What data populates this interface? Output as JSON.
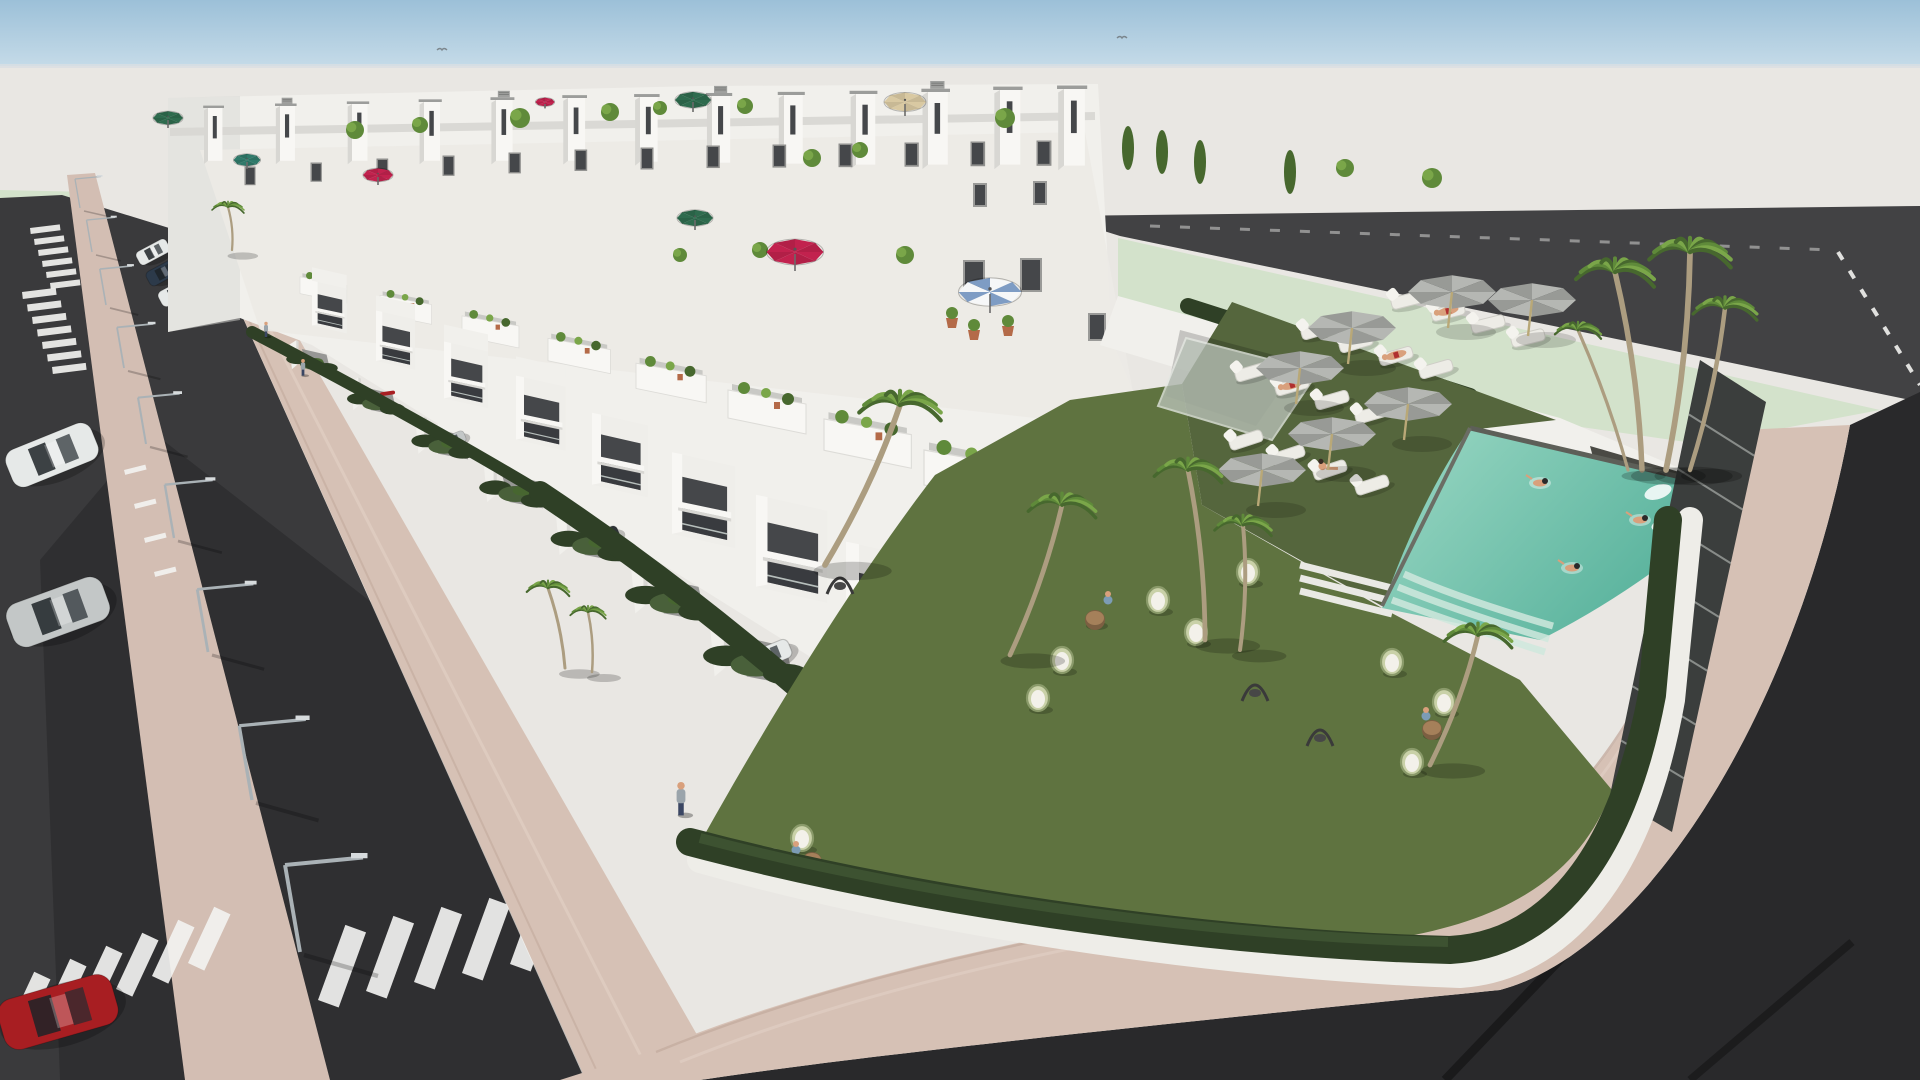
{
  "scene": {
    "description_labels": {
      "subject": "aerial-3d-render-residential-complex-with-pool",
      "sky": "clear-sky-band",
      "foreground": "asphalt-street-with-crosswalks",
      "amenity": "communal-pool-garden"
    },
    "palette": {
      "sky_top": "#9cc0d8",
      "sky_bottom": "#c7dce9",
      "horizon": "#d9dfe2",
      "backdrop": "#e9e7e3",
      "road": "#3a3a3c",
      "road_far": "#424244",
      "road_corner": "#29292b",
      "road_line": "#f2f2f0",
      "pavement": "#d6c1b5",
      "pavement_edge": "#c4aca0",
      "pavement_light": "#e3d2c7",
      "median": "#d3beb3",
      "wall_white": "#f1f0ec",
      "wall_bright": "#f8f7f4",
      "wall_shade": "#d8d7d3",
      "wall_dark": "#bfbeba",
      "glass": "#45474a",
      "glass_dark": "#323438",
      "rail": "#ccd5d1",
      "green_bg": "#d3e2cb",
      "hedge": "#2f4026",
      "hedge_light": "#49603a",
      "lawn": "#5f7340",
      "lawn_dark": "#55663d",
      "pool_light": "#9bd8c4",
      "pool_deep": "#58b29c",
      "pool_step": "#cfe8dd",
      "palm_dark": "#47682e",
      "palm_mid": "#5f8a3a",
      "palm_light": "#7aa649",
      "trunk": "#ac9d80",
      "parasol": "#b5b7b3",
      "parasol_shade": "#989a96",
      "lounger": "#edece6",
      "umbrella_green": "#2e6b4e",
      "umbrella_teal": "#2f7a6a",
      "umbrella_red": "#c2224e",
      "umbrella_tan": "#d9c9a2",
      "umbrella_stripe_a": "#f6f7f8",
      "umbrella_stripe_b": "#7e9cc4",
      "terracotta": "#b46a48",
      "skin": "#d9a07c",
      "metal": "#aab2b6",
      "car_white": "#e6e9e8",
      "car_silver": "#c3c7c7",
      "car_navy": "#2c3a4a",
      "car_red": "#a81e22",
      "car_yellow": "#c8a23c",
      "car_suv": "#2e3336"
    },
    "birds": [
      [
        442,
        50
      ],
      [
        1122,
        38
      ]
    ],
    "umbrellas": [
      [
        168,
        118,
        0.5,
        "green"
      ],
      [
        247,
        160,
        0.45,
        "teal"
      ],
      [
        545,
        102,
        0.32,
        "red"
      ],
      [
        378,
        175,
        0.5,
        "red"
      ],
      [
        693,
        100,
        0.6,
        "green"
      ],
      [
        695,
        218,
        0.6,
        "green"
      ],
      [
        905,
        102,
        0.7,
        "tan"
      ],
      [
        795,
        252,
        0.95,
        "red"
      ],
      [
        990,
        292,
        1.05,
        "stripe"
      ]
    ],
    "parasols": [
      [
        1452,
        292
      ],
      [
        1532,
        300
      ],
      [
        1352,
        328
      ],
      [
        1300,
        368
      ],
      [
        1408,
        404
      ],
      [
        1332,
        434
      ],
      [
        1262,
        470
      ]
    ],
    "loungers": [
      [
        1408,
        300,
        -14,
        0
      ],
      [
        1448,
        312,
        -14,
        1
      ],
      [
        1488,
        324,
        -14,
        0
      ],
      [
        1528,
        338,
        -14,
        0
      ],
      [
        1318,
        330,
        -16,
        0
      ],
      [
        1356,
        343,
        -16,
        0
      ],
      [
        1396,
        356,
        -16,
        1
      ],
      [
        1436,
        369,
        -16,
        0
      ],
      [
        1252,
        372,
        -16,
        0
      ],
      [
        1292,
        386,
        -16,
        1
      ],
      [
        1332,
        400,
        -16,
        0
      ],
      [
        1372,
        414,
        -16,
        0
      ],
      [
        1246,
        440,
        -18,
        0
      ],
      [
        1288,
        455,
        -18,
        0
      ],
      [
        1330,
        470,
        -18,
        2
      ],
      [
        1372,
        485,
        -18,
        0
      ]
    ],
    "palms": [
      [
        825,
        565,
        900,
        405,
        1.15
      ],
      [
        1010,
        655,
        1062,
        505,
        0.95
      ],
      [
        565,
        668,
        548,
        588,
        0.6
      ],
      [
        592,
        672,
        588,
        612,
        0.5
      ],
      [
        1205,
        640,
        1188,
        470,
        0.95
      ],
      [
        1240,
        650,
        1243,
        525,
        0.8
      ],
      [
        1430,
        765,
        1478,
        635,
        0.95
      ],
      [
        1642,
        470,
        1615,
        272,
        1.1
      ],
      [
        1666,
        470,
        1690,
        252,
        1.15
      ],
      [
        1690,
        470,
        1725,
        308,
        0.9
      ],
      [
        1628,
        470,
        1578,
        330,
        0.65
      ],
      [
        232,
        250,
        228,
        207,
        0.45
      ]
    ],
    "lamps": [
      [
        80,
        208,
        0.5
      ],
      [
        92,
        252,
        0.55
      ],
      [
        106,
        305,
        0.62
      ],
      [
        124,
        368,
        0.7
      ],
      [
        146,
        444,
        0.8
      ],
      [
        174,
        538,
        0.92
      ],
      [
        208,
        652,
        1.08
      ],
      [
        252,
        800,
        1.28
      ],
      [
        300,
        952,
        1.5
      ]
    ],
    "street_cars": [
      [
        153,
        252,
        -28,
        34,
        15,
        "car_white"
      ],
      [
        164,
        272,
        -28,
        36,
        16,
        "car_navy"
      ],
      [
        177,
        292,
        -28,
        38,
        17,
        "car_white"
      ]
    ],
    "parked_cars": [
      [
        52,
        455,
        -22,
        92,
        40,
        "car_white"
      ],
      [
        58,
        612,
        -20,
        102,
        46,
        "car_silver"
      ],
      [
        58,
        1012,
        -16,
        118,
        52,
        "car_red"
      ]
    ],
    "pedestrians": [
      [
        266,
        330,
        0.5
      ],
      [
        303,
        368,
        0.55
      ],
      [
        681,
        800,
        1.1
      ]
    ],
    "swimmers": [
      [
        1540,
        483
      ],
      [
        1572,
        568
      ],
      [
        1640,
        520
      ]
    ],
    "egg_chairs": [
      [
        1158,
        600
      ],
      [
        1248,
        572
      ],
      [
        1196,
        632
      ],
      [
        1062,
        660
      ],
      [
        1038,
        698
      ],
      [
        1392,
        662
      ],
      [
        1444,
        702
      ],
      [
        1412,
        762
      ],
      [
        802,
        838
      ],
      [
        772,
        862
      ]
    ],
    "tables": [
      [
        1095,
        620
      ],
      [
        812,
        862
      ],
      [
        1432,
        730
      ]
    ],
    "sitters": [
      [
        1108,
        600
      ],
      [
        796,
        850
      ],
      [
        1426,
        716
      ]
    ],
    "swings": [
      [
        840,
        578
      ],
      [
        1255,
        685
      ],
      [
        1320,
        730
      ]
    ],
    "crosswalks": [
      {
        "x": 30,
        "y": 228,
        "count": 6,
        "len": 30,
        "w": 6,
        "stepx": 4,
        "stepy": 11,
        "rot": -7
      },
      {
        "x": 22,
        "y": 292,
        "count": 7,
        "len": 34,
        "w": 7,
        "stepx": 5,
        "stepy": 12.5,
        "rot": -7
      },
      {
        "x": 178,
        "y": 206,
        "count": 5,
        "len": 16,
        "w": 4,
        "stepx": 14,
        "stepy": 4,
        "rot": -10
      },
      {
        "x": 124,
        "y": 470,
        "count": 4,
        "len": 22,
        "w": 5,
        "stepx": 10,
        "stepy": 34,
        "rot": -14
      },
      {
        "x": 8,
        "y": 1028,
        "count": 6,
        "len": 62,
        "w": 18,
        "stepx": 36,
        "stepy": -13,
        "rot": -65
      },
      {
        "x": 318,
        "y": 1000,
        "count": 6,
        "len": 80,
        "w": 22,
        "stepx": 48,
        "stepy": -9,
        "rot": -70
      }
    ],
    "dashes": [
      {
        "pts": "412,420 543,452",
        "w": 5,
        "da": "14 12",
        "op": 0.85
      },
      {
        "pts": "1838,252 1920,385",
        "w": 4,
        "da": "9 13",
        "op": 0.9
      },
      {
        "pts": "1150,226 1834,250",
        "w": 3,
        "da": "10 20",
        "op": 0.45
      }
    ],
    "building": {
      "towers": [
        [
          208,
          108
        ],
        [
          280,
          106
        ],
        [
          352,
          104
        ],
        [
          424,
          102
        ],
        [
          496,
          100
        ],
        [
          568,
          98
        ],
        [
          640,
          97
        ],
        [
          712,
          96
        ],
        [
          784,
          95
        ],
        [
          856,
          94
        ],
        [
          928,
          92
        ],
        [
          1000,
          90
        ],
        [
          1064,
          89
        ]
      ],
      "windows": [
        [
          246,
          168
        ],
        [
          312,
          164
        ],
        [
          378,
          160
        ],
        [
          444,
          157
        ],
        [
          510,
          154
        ],
        [
          576,
          151
        ],
        [
          642,
          149
        ],
        [
          708,
          147
        ],
        [
          774,
          146
        ],
        [
          840,
          145
        ],
        [
          906,
          144
        ],
        [
          972,
          143
        ],
        [
          1038,
          142
        ]
      ],
      "big_windows": [
        [
          965,
          262,
          18,
          30
        ],
        [
          1022,
          260,
          18,
          30
        ],
        [
          1090,
          315,
          14,
          24
        ],
        [
          975,
          185,
          10,
          20
        ],
        [
          1035,
          183,
          10,
          20
        ]
      ],
      "terraces": [
        [
          300,
          272,
          0.6
        ],
        [
          380,
          290,
          0.66
        ],
        [
          462,
          310,
          0.73
        ],
        [
          548,
          332,
          0.8
        ],
        [
          636,
          356,
          0.9
        ],
        [
          728,
          382,
          1.0
        ],
        [
          824,
          410,
          1.12
        ],
        [
          924,
          440,
          1.25
        ]
      ],
      "units": [
        [
          312,
          330,
          0.56
        ],
        [
          376,
          366,
          0.63
        ],
        [
          444,
          404,
          0.71
        ],
        [
          516,
          446,
          0.8
        ],
        [
          592,
          492,
          0.9
        ],
        [
          672,
          542,
          1.02
        ],
        [
          756,
          596,
          1.15
        ],
        [
          846,
          656,
          1.3
        ],
        [
          942,
          722,
          1.47
        ]
      ],
      "unit_cars": {
        "1": "redstrip",
        "2": "car_silver",
        "4": "car_suv",
        "6": "car_white",
        "7": "car_yellow"
      },
      "roof_plants": [
        [
          355,
          130,
          9
        ],
        [
          420,
          125,
          8
        ],
        [
          520,
          118,
          10
        ],
        [
          610,
          112,
          9
        ],
        [
          660,
          108,
          7
        ],
        [
          745,
          106,
          8
        ],
        [
          812,
          158,
          9
        ],
        [
          860,
          150,
          8
        ],
        [
          1005,
          118,
          10
        ],
        [
          1345,
          168,
          9
        ],
        [
          1432,
          178,
          10
        ],
        [
          905,
          255,
          9
        ],
        [
          760,
          250,
          8
        ],
        [
          680,
          255,
          7
        ]
      ],
      "cypress": [
        [
          1128,
          148
        ],
        [
          1162,
          152
        ],
        [
          1200,
          162
        ],
        [
          1290,
          172
        ]
      ]
    }
  }
}
